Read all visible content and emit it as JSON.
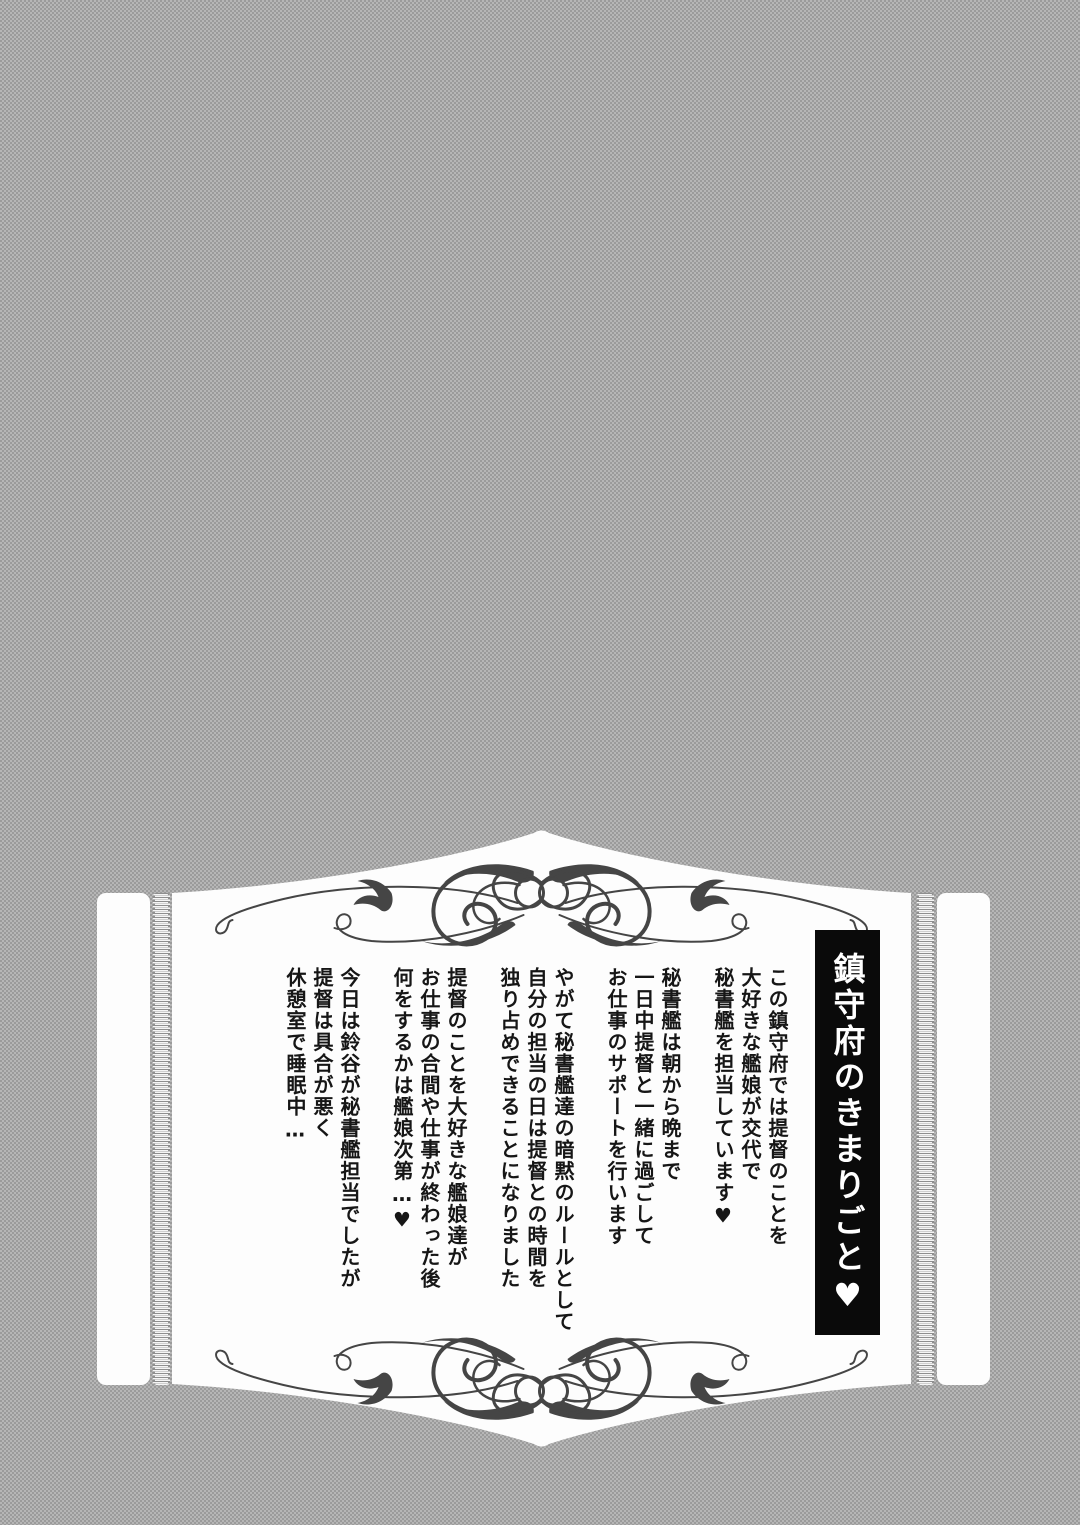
{
  "page": {
    "tone_color": "#a8a8a8",
    "panel_color": "#fdfdfd"
  },
  "panel": {
    "title": "鎮守府のきまりごと♥",
    "title_box": {
      "background": "#0a0a0a",
      "text_color": "#ffffff"
    },
    "ornaments": {
      "top": "scroll-flourish",
      "bottom": "scroll-flourish-mirrored",
      "side_trim": "lace-ribbon-border",
      "color": "#454545"
    },
    "text_groups": [
      {
        "lines": [
          "この鎮守府では提督のことを",
          "大好きな艦娘が交代で",
          "秘書艦を担当しています♥"
        ]
      },
      {
        "lines": [
          "秘書艦は朝から晩まで",
          "一日中提督と一緒に過ごして",
          "お仕事のサポートを行います"
        ]
      },
      {
        "lines": [
          "やがて秘書艦達の暗黙のルールとして",
          "自分の担当の日は提督との時間を",
          "独り占めできることになりました"
        ]
      },
      {
        "lines": [
          "提督のことを大好きな艦娘達が",
          "お仕事の合間や仕事が終わった後",
          "何をするかは艦娘次第…♥"
        ]
      },
      {
        "lines": [
          "今日は鈴谷が秘書艦担当でしたが",
          "提督は具合が悪く",
          "休憩室で睡眠中…"
        ]
      }
    ]
  }
}
